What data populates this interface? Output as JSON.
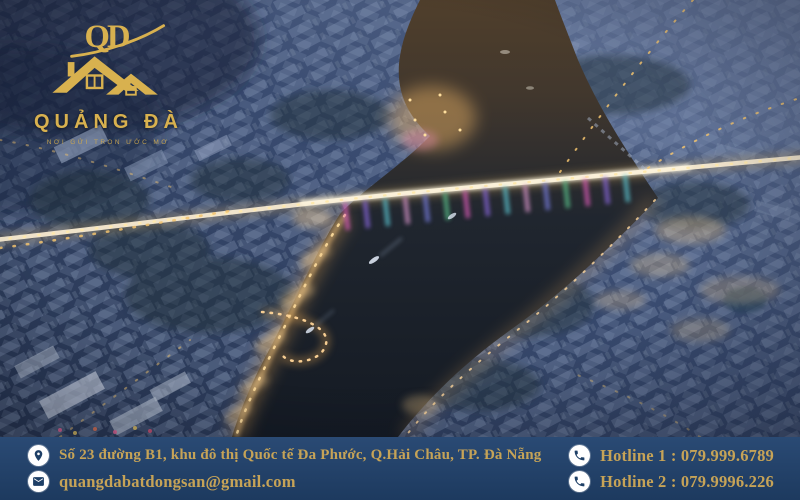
{
  "brand": {
    "monogram": "QD",
    "name": "QUẢNG ĐÀ",
    "tagline": "NƠI GỬI TRỌN ƯỚC MƠ",
    "colors": {
      "logo_gold": "#d8b14f",
      "footer_text_gold": "#c6a357",
      "footer_navy": "#23456e",
      "icon_glyph_navy": "#1e3f66",
      "icon_background": "#ffffff"
    }
  },
  "contact": {
    "address": "Số 23 đường B1, khu đô thị Quốc tế Đa Phước, Q.Hải Châu, TP. Đà Nẵng",
    "email": "quangdabatdongsan@gmail.com",
    "hotline1": "Hotline 1 : 079.999.6789",
    "hotline2": "Hotline 2 : 079.9996.226"
  },
  "icons": {
    "address": "location-pin",
    "email": "envelope",
    "hotline": "phone-handset"
  }
}
